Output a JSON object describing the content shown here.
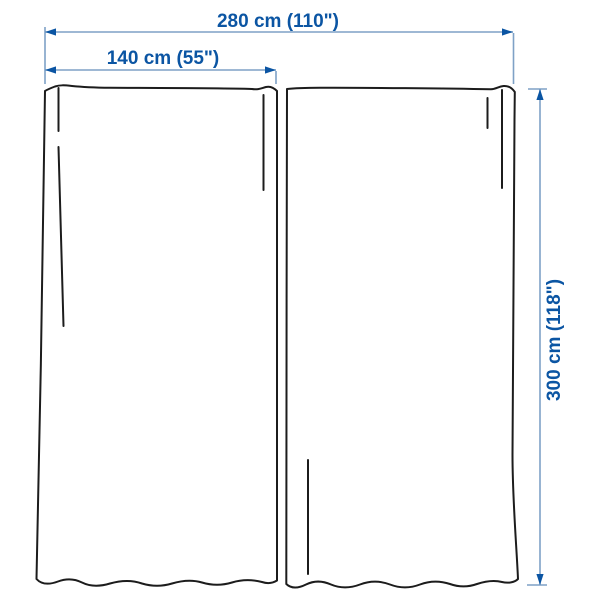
{
  "diagram": {
    "measurements": {
      "total_width": "280 cm (110\")",
      "panel_width": "140 cm (55\")",
      "height": "300 cm (118\")"
    }
  },
  "colors": {
    "outline": "#1c1c1c",
    "dim-line": "#7fa1c6",
    "dim-accent": "#0b55a3",
    "background": "#ffffff"
  }
}
